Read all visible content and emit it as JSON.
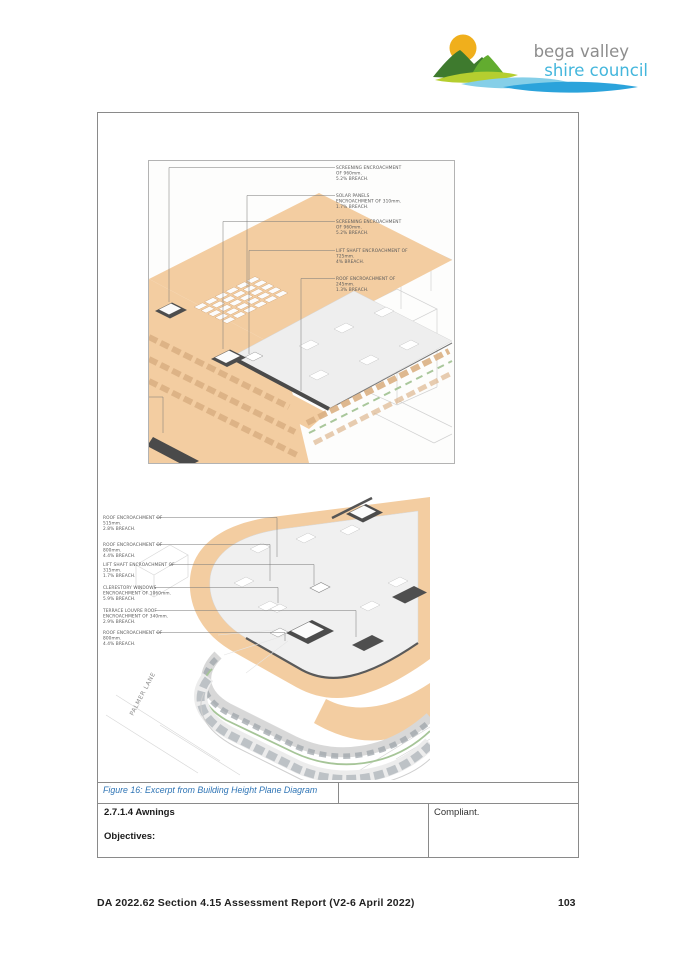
{
  "logo": {
    "line1": "bega valley",
    "line2": "shire council"
  },
  "figure": {
    "caption": "Figure 16: Excerpt from Building Height Plane Diagram",
    "top_diagram": {
      "labels": [
        [
          "SCREENING ENCROACHMENT",
          "OF 960mm.",
          "5.2% BREACH."
        ],
        [
          "SOLAR PANELS",
          "ENCROACHMENT OF 310mm.",
          "1.7% BREACH."
        ],
        [
          "SCREENING ENCROACHMENT",
          "OF 960mm.",
          "5.2% BREACH."
        ],
        [
          "LIFT SHAFT ENCROACHMENT OF",
          "725mm.",
          "4% BREACH."
        ],
        [
          "ROOF ENCROACHMENT OF",
          "245mm.",
          "1.3% BREACH."
        ]
      ]
    },
    "bottom_diagram": {
      "street_label": "PALMER LANE",
      "labels": [
        [
          "ROOF ENCROACHMENT OF",
          "515mm.",
          "2.8% BREACH."
        ],
        [
          "ROOF ENCROACHMENT OF",
          "800mm.",
          "4.4% BREACH."
        ],
        [
          "LIFT SHAFT ENCROACHMENT OF",
          "315mm.",
          "1.7% BREACH."
        ],
        [
          "CLERESTORY WINDOWS",
          "ENCROACHMENT OF 1060mm.",
          "5.9% BREACH."
        ],
        [
          "TERRACE LOUVRE ROOF",
          "ENCROACHMENT OF 340mm.",
          "2.9% BREACH."
        ],
        [
          "ROOF ENCROACHMENT OF",
          "800mm.",
          "4.4% BREACH."
        ]
      ]
    }
  },
  "assessment_table": {
    "section_title": "2.7.1.4 Awnings",
    "section_subheading": "Objectives:",
    "status": "Compliant."
  },
  "footer": {
    "report_title": "DA 2022.62 Section 4.15 Assessment Report (V2-6 April 2022)",
    "page_number": "103"
  },
  "colors": {
    "height_plane_orange": "#F3CDA1",
    "caption_blue": "#2E74B5",
    "logo_sun": "#F0AF1C",
    "logo_dark_green": "#3E7A2E",
    "logo_light_green": "#62AC2F",
    "logo_lime": "#B5CE2F",
    "logo_light_blue": "#85CFE8",
    "logo_mid_blue": "#2BA3DB",
    "logo_text_gray": "#8D8D8D",
    "logo_text_blue": "#43B6DC"
  }
}
